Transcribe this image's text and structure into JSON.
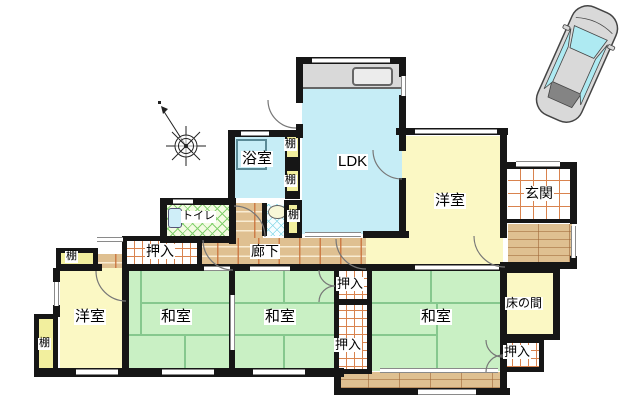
{
  "canvas": {
    "width": 640,
    "height": 409,
    "background": "#ffffff"
  },
  "colors": {
    "wall": "#161616",
    "room_cyan": "#c6edf6",
    "room_yellow": "#fbf8c4",
    "room_green": "#c9f0c4",
    "shelf_yellow": "#f2ef9e",
    "wood": "#dfc091",
    "grid_orange": "#d9834e",
    "hatch_green": "#82d06e",
    "hatch_cyan": "#86d8e8",
    "counter_gray": "#d9d9d9",
    "car_body": "#d9d9d9",
    "car_glass": "#aeeaf2"
  },
  "labels": {
    "ldk": "LDK",
    "bath": "浴室",
    "toilet": "トイレ",
    "corridor": "廊下",
    "entrance": "玄関",
    "western_room": "洋室",
    "japanese_room": "和室",
    "closet": "押入",
    "shelf": "棚",
    "alcove": "床の間"
  },
  "rooms": [
    {
      "id": "ldk",
      "label": "LDK"
    },
    {
      "id": "bathroom",
      "label": "浴室"
    },
    {
      "id": "toilet",
      "label": "トイレ"
    },
    {
      "id": "corridor",
      "label": "廊下"
    },
    {
      "id": "entrance",
      "label": "玄関"
    },
    {
      "id": "western-room-upper-right",
      "label": "洋室"
    },
    {
      "id": "western-room-lower-left",
      "label": "洋室"
    },
    {
      "id": "japanese-room-left",
      "label": "和室"
    },
    {
      "id": "japanese-room-center",
      "label": "和室"
    },
    {
      "id": "japanese-room-right",
      "label": "和室"
    },
    {
      "id": "alcove",
      "label": "床の間"
    },
    {
      "id": "closet-northwest",
      "label": "押入"
    },
    {
      "id": "closet-center-upper",
      "label": "押入"
    },
    {
      "id": "closet-center-lower",
      "label": "押入"
    },
    {
      "id": "closet-southeast",
      "label": "押入"
    },
    {
      "id": "shelf-bath-upper",
      "label": "棚"
    },
    {
      "id": "shelf-bath-lower",
      "label": "棚"
    },
    {
      "id": "shelf-washstand",
      "label": "棚"
    },
    {
      "id": "shelf-west-upper",
      "label": "棚"
    },
    {
      "id": "shelf-west-lower",
      "label": "棚"
    }
  ],
  "decorations": {
    "compass": "compass-rose",
    "vehicle": "car-top-view"
  }
}
